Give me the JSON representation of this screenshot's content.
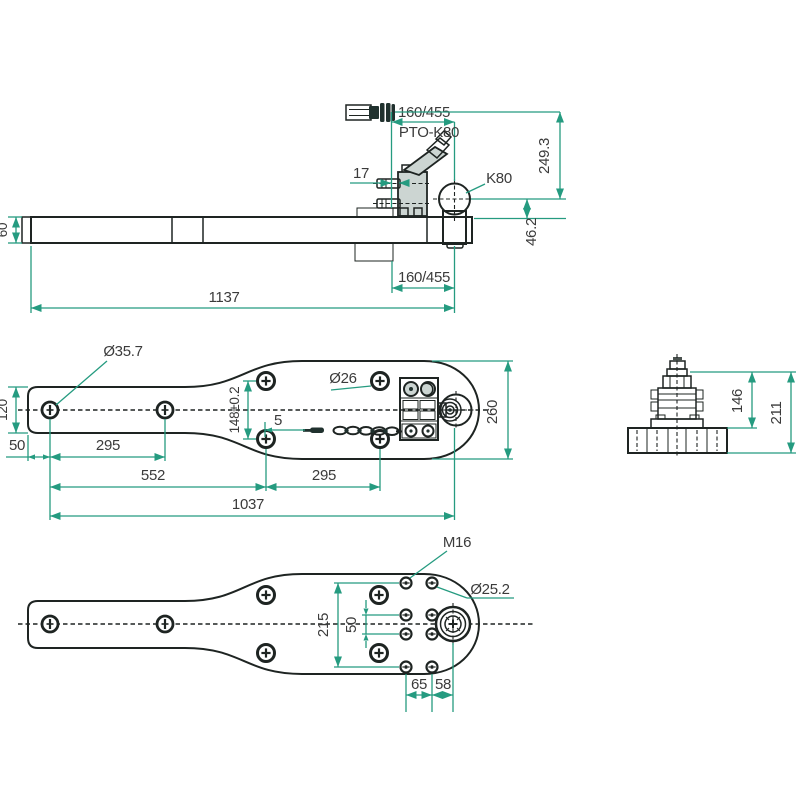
{
  "views": {
    "side": {
      "d160_top": "160/455",
      "pto_label": "PTO-K80",
      "d17": "17",
      "k80_label": "K80",
      "d249": "249.3",
      "d60": "60",
      "d46": "46.2",
      "d160_bottom": "160/455",
      "d1137": "1137"
    },
    "top": {
      "d35": "Ø35.7",
      "d120": "120",
      "d50": "50",
      "d295l": "295",
      "d552": "552",
      "d295r": "295",
      "d1037": "1037",
      "d148": "148±0.2",
      "d5": "5",
      "d26": "Ø26",
      "d260": "260"
    },
    "end": {
      "d146": "146",
      "d211": "211"
    },
    "bottom": {
      "m16": "M16",
      "d25": "Ø25.2",
      "d215": "215",
      "d50": "50",
      "d65": "65",
      "d58": "58"
    }
  },
  "colors": {
    "body_fill": "#8fa8a3",
    "part_fill": "#ccd5d2",
    "ball_fill": "#b7c1be",
    "outline": "#1e2422",
    "dimension_line": "#259b80",
    "text": "#3b3b3b",
    "background": "#ffffff"
  }
}
